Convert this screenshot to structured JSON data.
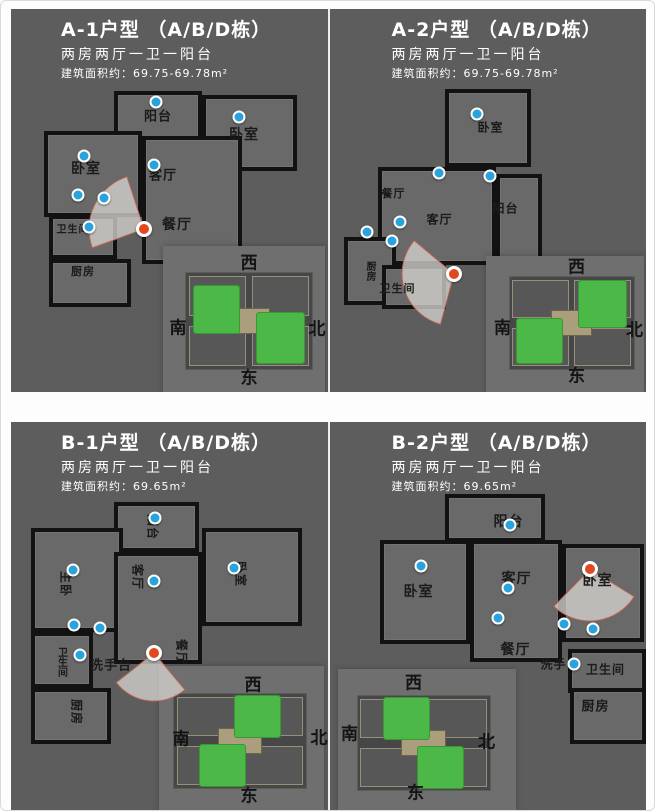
{
  "colors": {
    "panel_bg": "#5d5d5d",
    "wall": "#121212",
    "hotspot_blue": "#2aa3dc",
    "camera_red": "#e2481e",
    "highlight_green": "#4cb848",
    "title_text": "#ffffff"
  },
  "compass": {
    "top": "西",
    "left": "南",
    "right": "北",
    "bottom": "东"
  },
  "units": [
    {
      "id": "A-1",
      "title": "A-1户型 （A/B/D栋）",
      "subtitle": "两房两厅一卫一阳台",
      "area": "建筑面积约：69.75-69.78m²",
      "rooms": [
        {
          "name": "balcony",
          "label": "阳台",
          "box": [
            103,
            82,
            88,
            50
          ],
          "at": [
            147,
            106
          ],
          "size": 13
        },
        {
          "name": "bedroom-right",
          "label": "卧室",
          "box": [
            191,
            86,
            95,
            76
          ],
          "at": [
            233,
            125
          ],
          "size": 14
        },
        {
          "name": "bedroom-left",
          "label": "卧室",
          "box": [
            33,
            122,
            98,
            86
          ],
          "at": [
            75,
            159
          ],
          "size": 14
        },
        {
          "name": "living-room",
          "label": "客厅",
          "box": [
            131,
            127,
            100,
            128
          ],
          "at": [
            152,
            165
          ],
          "size": 13
        },
        {
          "name": "dining-room",
          "label": "餐厅",
          "at": [
            166,
            215
          ],
          "size": 14
        },
        {
          "name": "bathroom",
          "label": "卫生间",
          "box": [
            38,
            206,
            68,
            44
          ],
          "at": [
            62,
            219
          ],
          "size": 10
        },
        {
          "name": "kitchen",
          "label": "厨房",
          "box": [
            38,
            250,
            82,
            48
          ],
          "at": [
            72,
            262
          ],
          "size": 11
        }
      ],
      "dots": [
        [
          145,
          93
        ],
        [
          228,
          108
        ],
        [
          73,
          147
        ],
        [
          143,
          156
        ],
        [
          67,
          186
        ],
        [
          93,
          189
        ],
        [
          78,
          218
        ]
      ],
      "camera": {
        "x": 133,
        "y": 220,
        "r": 55,
        "a1": 160,
        "a2": 252
      },
      "inset": {
        "box": [
          152,
          237,
          162,
          146
        ],
        "plan": [
          175,
          264,
          126,
          96
        ],
        "compass": {
          "top": "西",
          "left": "南",
          "right": "北",
          "bottom": "东"
        },
        "compass_at": {
          "top": [
            238,
            252
          ],
          "left": [
            167,
            317
          ],
          "right": [
            306,
            318
          ],
          "bottom": [
            238,
            367
          ]
        },
        "green": [
          [
            6,
            14,
            36,
            48
          ],
          [
            56,
            42,
            38,
            52
          ]
        ]
      }
    },
    {
      "id": "A-2",
      "title": "A-2户型 （A/B/D栋）",
      "subtitle": "两房两厅一卫一阳台",
      "area": "建筑面积约：69.75-69.78m²",
      "rooms": [
        {
          "name": "bedroom",
          "label": "卧室",
          "box": [
            115,
            80,
            86,
            78
          ],
          "at": [
            161,
            118
          ],
          "size": 12
        },
        {
          "name": "dining-room",
          "label": "餐厅",
          "at": [
            64,
            184
          ],
          "size": 11
        },
        {
          "name": "living-room",
          "label": "客厅",
          "box": [
            48,
            158,
            118,
            98
          ],
          "at": [
            110,
            210
          ],
          "size": 12
        },
        {
          "name": "balcony",
          "label": "阳台",
          "box": [
            166,
            165,
            46,
            92
          ],
          "at": [
            176,
            199
          ],
          "size": 12
        },
        {
          "name": "kitchen",
          "label": "厨房",
          "box": [
            14,
            228,
            52,
            68
          ],
          "at": [
            40,
            262
          ],
          "mode": "v",
          "size": 10
        },
        {
          "name": "bathroom",
          "label": "卫生间",
          "box": [
            52,
            256,
            64,
            44
          ],
          "at": [
            68,
            279
          ],
          "size": 11
        }
      ],
      "dots": [
        [
          147,
          105
        ],
        [
          109,
          164
        ],
        [
          160,
          167
        ],
        [
          70,
          213
        ],
        [
          37,
          223
        ],
        [
          62,
          232
        ]
      ],
      "camera": {
        "x": 124,
        "y": 265,
        "r": 52,
        "a1": 105,
        "a2": 220
      },
      "inset": {
        "box": [
          156,
          247,
          158,
          136
        ],
        "plan": [
          180,
          268,
          124,
          92
        ],
        "compass": {
          "top": "西",
          "left": "南",
          "right": "北",
          "bottom": "东"
        },
        "compass_at": {
          "top": [
            247,
            256
          ],
          "left": [
            173,
            317
          ],
          "right": [
            305,
            319
          ],
          "bottom": [
            247,
            365
          ]
        },
        "green": [
          [
            56,
            4,
            38,
            50
          ],
          [
            6,
            46,
            36,
            48
          ]
        ]
      }
    },
    {
      "id": "B-1",
      "title": "B-1户型 （A/B/D栋）",
      "subtitle": "两房两厅一卫一阳台",
      "area": "建筑面积约：69.65m²",
      "rooms": [
        {
          "name": "balcony",
          "label": "阳台",
          "box": [
            103,
            80,
            85,
            50
          ],
          "at": [
            142,
            105
          ],
          "mode": "r",
          "size": 12
        },
        {
          "name": "master-bedroom",
          "label": "主卧",
          "box": [
            20,
            106,
            92,
            104
          ],
          "at": [
            55,
            162
          ],
          "mode": "r",
          "size": 12
        },
        {
          "name": "living-room",
          "label": "客厅",
          "box": [
            103,
            130,
            88,
            112
          ],
          "at": [
            127,
            155
          ],
          "mode": "r",
          "size": 12
        },
        {
          "name": "bedroom",
          "label": "卧室",
          "box": [
            191,
            106,
            100,
            98
          ],
          "at": [
            230,
            152
          ],
          "mode": "r",
          "size": 12
        },
        {
          "name": "bathroom",
          "label": "卫生间",
          "box": [
            20,
            210,
            62,
            56
          ],
          "at": [
            50,
            240
          ],
          "mode": "v",
          "size": 10
        },
        {
          "name": "washbasin",
          "label": "洗手台",
          "at": [
            100,
            242
          ],
          "size": 13
        },
        {
          "name": "kitchen",
          "label": "厨房",
          "box": [
            20,
            266,
            80,
            56
          ],
          "at": [
            66,
            290
          ],
          "mode": "r",
          "size": 12
        },
        {
          "name": "dining-room",
          "label": "餐厅",
          "at": [
            171,
            230
          ],
          "mode": "r",
          "size": 12
        }
      ],
      "dots": [
        [
          144,
          96
        ],
        [
          62,
          148
        ],
        [
          143,
          159
        ],
        [
          223,
          146
        ],
        [
          63,
          203
        ],
        [
          89,
          206
        ],
        [
          69,
          233
        ]
      ],
      "camera": {
        "x": 143,
        "y": 231,
        "r": 48,
        "a1": 50,
        "a2": 142
      },
      "inset": {
        "box": [
          148,
          244,
          165,
          144
        ],
        "plan": [
          163,
          272,
          132,
          94
        ],
        "compass": {
          "top": "西",
          "left": "南",
          "right": "北",
          "bottom": "东"
        },
        "compass_at": {
          "top": [
            242,
            261
          ],
          "left": [
            170,
            315
          ],
          "right": [
            308,
            314
          ],
          "bottom": [
            238,
            372
          ]
        },
        "green": [
          [
            46,
            2,
            34,
            44
          ],
          [
            20,
            54,
            34,
            44
          ]
        ]
      }
    },
    {
      "id": "B-2",
      "title": "B-2户型 （A/B/D栋）",
      "subtitle": "两房两厅一卫一阳台",
      "area": "建筑面积约：69.65m²",
      "rooms": [
        {
          "name": "balcony",
          "label": "阳台",
          "box": [
            115,
            72,
            100,
            48
          ],
          "at": [
            179,
            99
          ],
          "size": 14
        },
        {
          "name": "bedroom-left",
          "label": "卧室",
          "box": [
            50,
            118,
            90,
            104
          ],
          "at": [
            89,
            169
          ],
          "size": 14
        },
        {
          "name": "living-room",
          "label": "客厅",
          "box": [
            140,
            118,
            92,
            122
          ],
          "at": [
            187,
            156
          ],
          "size": 14
        },
        {
          "name": "bedroom-right",
          "label": "卧室",
          "box": [
            232,
            122,
            82,
            98
          ],
          "at": [
            268,
            158
          ],
          "size": 14
        },
        {
          "name": "dining-room",
          "label": "餐厅",
          "at": [
            186,
            227
          ],
          "size": 14
        },
        {
          "name": "washbasin",
          "label": "洗手",
          "at": [
            224,
            242
          ],
          "size": 12
        },
        {
          "name": "bathroom",
          "label": "卫生间",
          "box": [
            238,
            227,
            78,
            44
          ],
          "at": [
            276,
            247
          ],
          "size": 12
        },
        {
          "name": "kitchen",
          "label": "厨房",
          "box": [
            240,
            266,
            76,
            56
          ],
          "at": [
            266,
            283
          ],
          "size": 13
        }
      ],
      "dots": [
        [
          180,
          103
        ],
        [
          91,
          144
        ],
        [
          178,
          166
        ],
        [
          168,
          196
        ],
        [
          234,
          202
        ],
        [
          263,
          207
        ],
        [
          244,
          242
        ]
      ],
      "camera": {
        "x": 260,
        "y": 147,
        "r": 52,
        "a1": 32,
        "a2": 134
      },
      "inset": {
        "box": [
          8,
          247,
          178,
          141
        ],
        "plan": [
          28,
          274,
          132,
          94
        ],
        "compass": {
          "top": "西",
          "left": "南",
          "right": "北",
          "bottom": "东"
        },
        "compass_at": {
          "top": [
            84,
            259
          ],
          "left": [
            20,
            310
          ],
          "right": [
            157,
            318
          ],
          "bottom": [
            86,
            369
          ]
        },
        "green": [
          [
            20,
            2,
            34,
            44
          ],
          [
            46,
            54,
            34,
            44
          ]
        ]
      }
    }
  ]
}
